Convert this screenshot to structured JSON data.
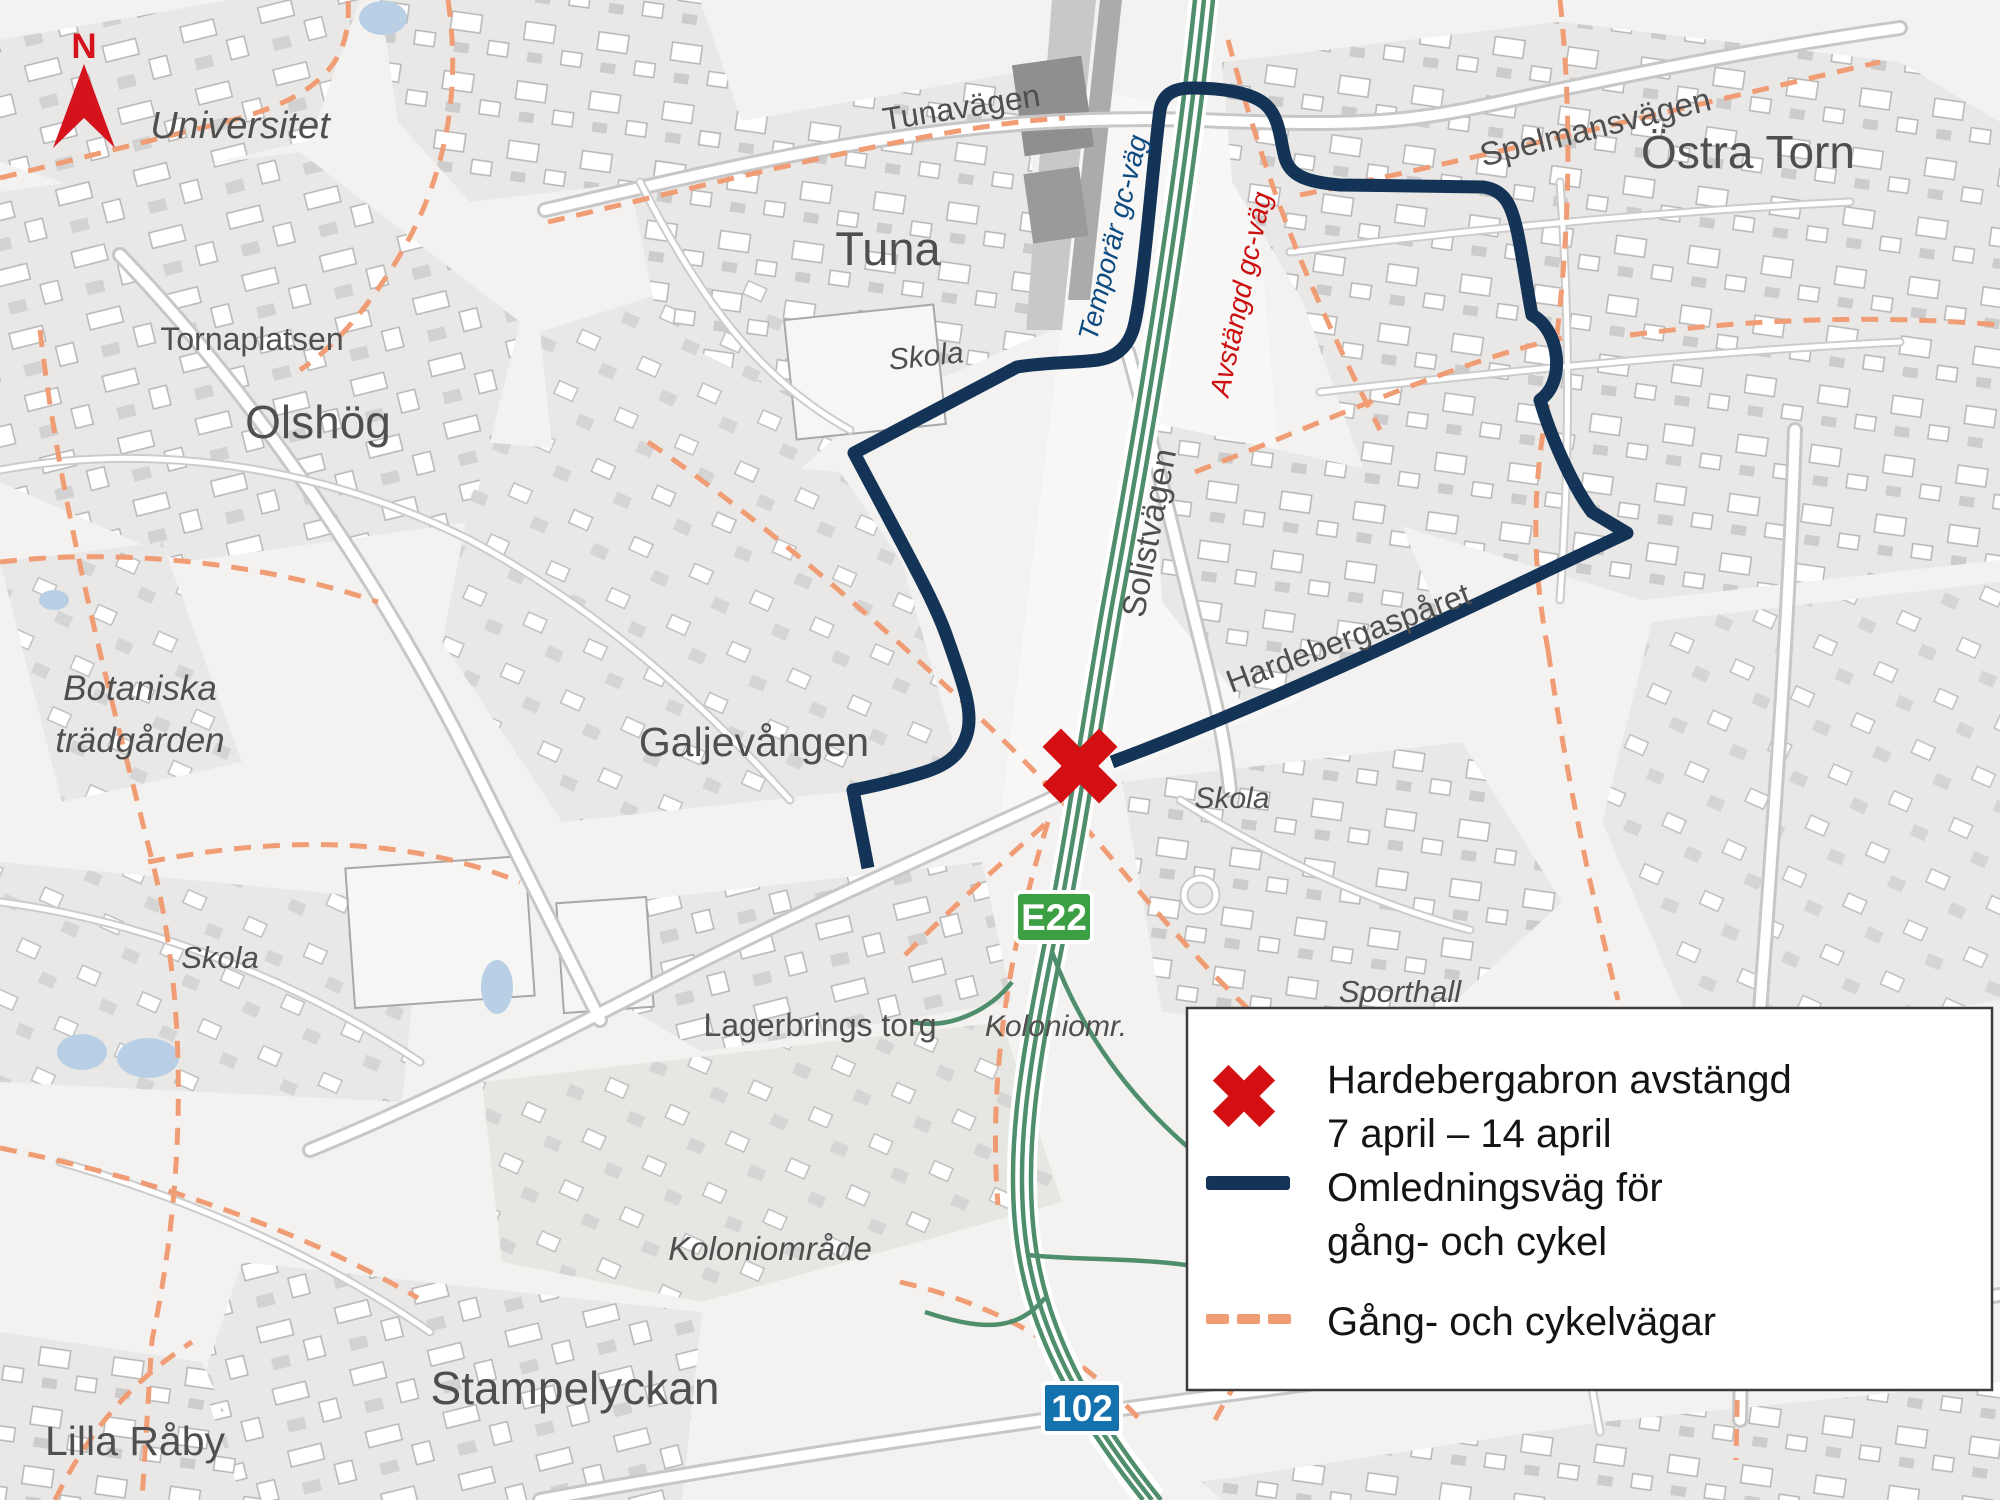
{
  "map": {
    "region_labels": {
      "universitet": "Universitet",
      "tornaplatsen": "Tornaplatsen",
      "olshog": "Olshög",
      "botaniska_line1": "Botaniska",
      "botaniska_line2": "trädgården",
      "skola_vast": "Skola",
      "tuna": "Tuna",
      "tunavagen": "Tunavägen",
      "skola_tuna": "Skola",
      "ostra_torn": "Östra Torn",
      "spelmansvagen": "Spelmansvägen",
      "solistvagen": "Solistvägen",
      "hardebergasparet": "Hardebergaspåret",
      "galjevangen": "Galjevången",
      "skola_ost": "Skola",
      "sporthall": "Sporthall",
      "lagerbrings_torg": "Lagerbrings torg",
      "koloniomr": "Koloniomr.",
      "koloniomrade": "Koloniområde",
      "stampelyckan": "Stampelyckan",
      "lilla_raby": "Lilla Råby"
    },
    "route_annotations": {
      "temporar_gc_vag": "Temporär gc-väg",
      "avstangd_gc_vag": "Avstängd gc-väg"
    },
    "badges": {
      "e22": "E22",
      "road_102": "102"
    },
    "north_label": "N",
    "colors": {
      "closure_red": "#d40f14",
      "detour_navy": "#133457",
      "gc_path_orange": "#f09d75",
      "highway_green": "#4f8e6c",
      "e22_badge_green": "#3c9f44",
      "road_102_badge_blue": "#1371ae"
    }
  },
  "legend": {
    "items": [
      {
        "icon": "closure-x-icon",
        "line1": "Hardebergabron avstängd",
        "line2": "7 april – 14 april"
      },
      {
        "icon": "detour-line-icon",
        "line1": "Omledningsväg för",
        "line2": "gång- och cykel"
      },
      {
        "icon": "gc-path-dashed-icon",
        "line1": "Gång- och cykelvägar",
        "line2": ""
      }
    ]
  }
}
